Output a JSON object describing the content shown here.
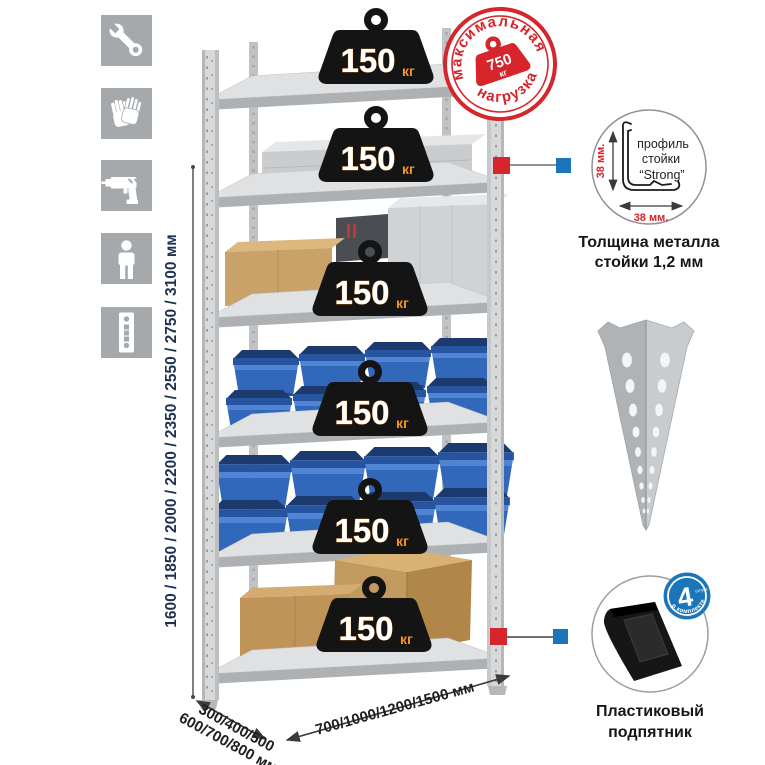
{
  "page": {
    "background": "#ffffff",
    "language": "ru"
  },
  "colors": {
    "accent_red": "#d6252b",
    "accent_blue": "#1b75bb",
    "bin_blue": "#3268ba",
    "weight_black": "#141414",
    "unit_orange": "#f7941d",
    "tile_gray": "#a6a9ac",
    "dimension_navy": "#1e3150"
  },
  "left_toolbar": {
    "icons": [
      {
        "name": "wrench"
      },
      {
        "name": "gloves"
      },
      {
        "name": "drill"
      },
      {
        "name": "person"
      },
      {
        "name": "rack-post"
      }
    ]
  },
  "height_dimension": {
    "label": "1600 / 1850 / 2000 / 2200 / 2350 / 2550 / 2750 / 3100 мм"
  },
  "depth_dimension": {
    "line1": "300/400/500",
    "line2": "600/700/800 мм"
  },
  "width_dimension": {
    "label": "700/1000/1200/1500 мм"
  },
  "shelf_load": {
    "value": "150",
    "unit": "кг",
    "shelf_count": 6
  },
  "max_load_stamp": {
    "arc_top": "максимальная",
    "arc_bottom": "нагрузка",
    "value": "750",
    "unit": "кг"
  },
  "profile_detail": {
    "line1": "профиль",
    "line2": "стойки",
    "line3": "“Strong”",
    "side_label": "38 мм.",
    "bottom_label": "38 мм.",
    "caption1": "Толщина металла",
    "caption2": "стойки 1,2 мм"
  },
  "foot_detail": {
    "badge_number": "4",
    "badge_small": "штуки",
    "badge_arc": "в комплекте",
    "caption1": "Пластиковый",
    "caption2": "подпятник"
  }
}
